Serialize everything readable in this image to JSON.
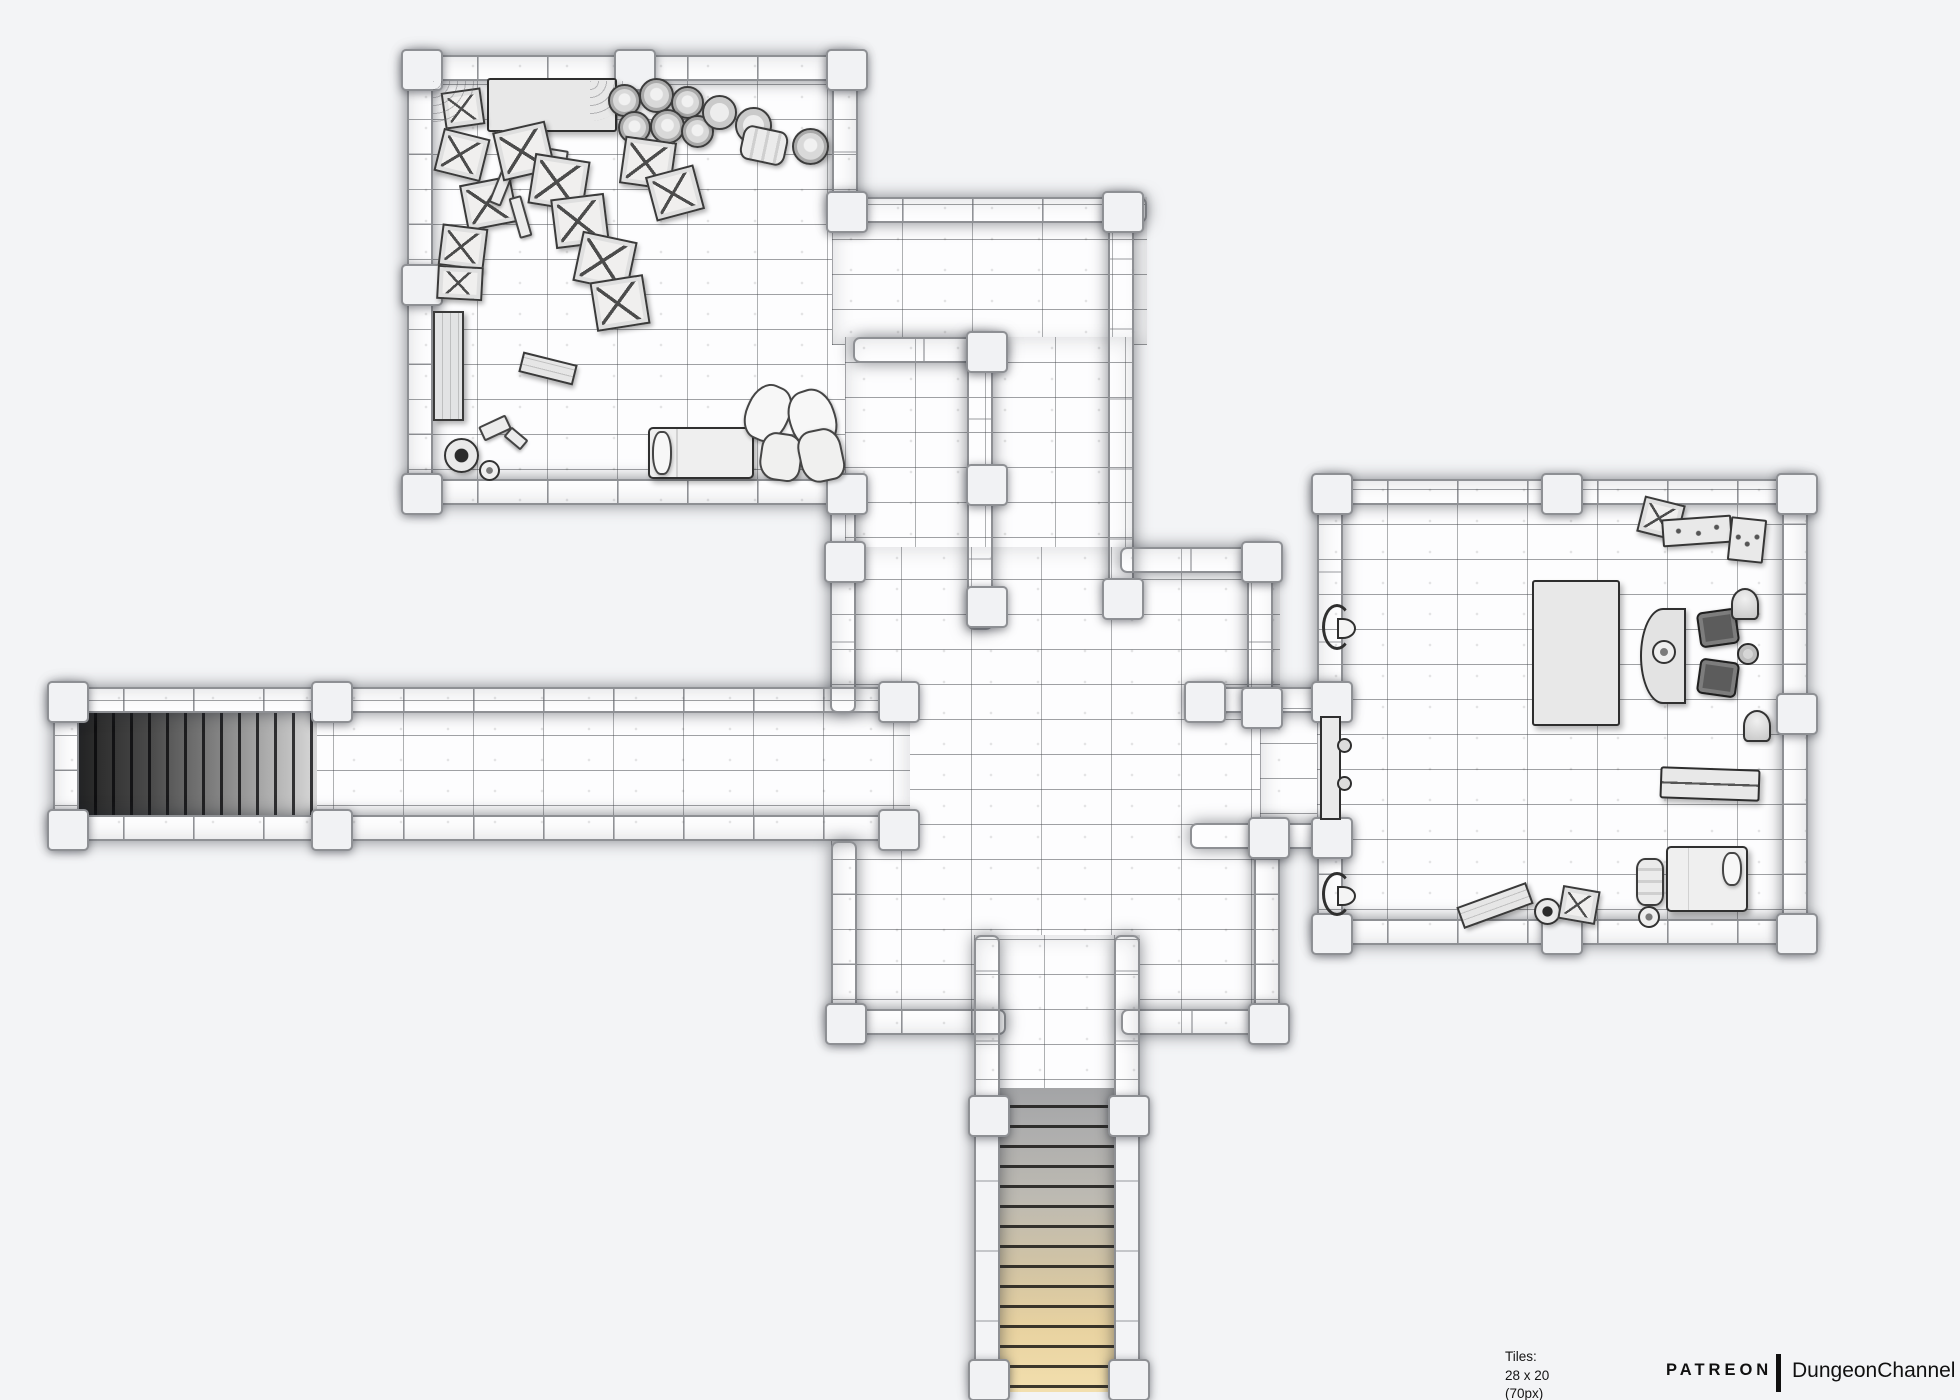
{
  "footer": {
    "tiles_label": "Tiles: 28 x 20 (70px)",
    "image_label": "Image: 1960 x 1400px",
    "brand": "PATREON",
    "channel": "DungeonChannel"
  },
  "map": {
    "colors": {
      "backdrop": "#f3f4f6",
      "floor": "#fdfdfe",
      "wall": "#e3e4e6",
      "wall_border": "#8e9094",
      "stairs_dark": "#242424",
      "stairs_light": "#d8d8d8",
      "stairs_tan": "#f2dfae"
    },
    "tile_size_px": 70,
    "grid": {
      "cols": 28,
      "rows": 20
    },
    "floors": [
      {
        "id": "storage-room",
        "x": 407,
        "y": 55,
        "w": 451,
        "h": 450
      },
      {
        "id": "east-corridor",
        "x": 832,
        "y": 197,
        "w": 315,
        "h": 148
      },
      {
        "id": "north-passages",
        "x": 845,
        "y": 337,
        "w": 289,
        "h": 236
      },
      {
        "id": "central-hall",
        "x": 831,
        "y": 547,
        "w": 449,
        "h": 488
      },
      {
        "id": "west-corridor",
        "x": 53,
        "y": 687,
        "w": 857,
        "h": 154
      },
      {
        "id": "door-passage",
        "x": 1260,
        "y": 687,
        "w": 83,
        "h": 162
      },
      {
        "id": "south-corridor",
        "x": 974,
        "y": 935,
        "w": 166,
        "h": 180
      },
      {
        "id": "study-bedroom",
        "x": 1317,
        "y": 479,
        "w": 491,
        "h": 466
      }
    ],
    "walls": [
      {
        "x": 407,
        "y": 55,
        "w": 451,
        "h": 26
      },
      {
        "x": 407,
        "y": 55,
        "w": 26,
        "h": 450
      },
      {
        "x": 407,
        "y": 479,
        "w": 451,
        "h": 26
      },
      {
        "x": 832,
        "y": 55,
        "w": 26,
        "h": 168
      },
      {
        "x": 830,
        "y": 505,
        "w": 26,
        "h": 208
      },
      {
        "x": 832,
        "y": 197,
        "w": 315,
        "h": 26
      },
      {
        "x": 853,
        "y": 337,
        "w": 153,
        "h": 26
      },
      {
        "x": 1108,
        "y": 197,
        "w": 26,
        "h": 413
      },
      {
        "x": 967,
        "y": 337,
        "w": 26,
        "h": 293
      },
      {
        "x": 1120,
        "y": 547,
        "w": 153,
        "h": 26
      },
      {
        "x": 1247,
        "y": 547,
        "w": 26,
        "h": 166
      },
      {
        "x": 1190,
        "y": 687,
        "w": 157,
        "h": 26
      },
      {
        "x": 1190,
        "y": 823,
        "w": 157,
        "h": 26
      },
      {
        "x": 1254,
        "y": 823,
        "w": 26,
        "h": 212
      },
      {
        "x": 1317,
        "y": 479,
        "w": 26,
        "h": 234
      },
      {
        "x": 1317,
        "y": 823,
        "w": 26,
        "h": 122
      },
      {
        "x": 1317,
        "y": 479,
        "w": 491,
        "h": 26
      },
      {
        "x": 1782,
        "y": 479,
        "w": 26,
        "h": 466
      },
      {
        "x": 1317,
        "y": 919,
        "w": 491,
        "h": 26
      },
      {
        "x": 53,
        "y": 687,
        "w": 857,
        "h": 26
      },
      {
        "x": 53,
        "y": 815,
        "w": 857,
        "h": 26
      },
      {
        "x": 53,
        "y": 687,
        "w": 26,
        "h": 154
      },
      {
        "x": 831,
        "y": 841,
        "w": 26,
        "h": 194
      },
      {
        "x": 831,
        "y": 1009,
        "w": 175,
        "h": 26
      },
      {
        "x": 1121,
        "y": 1009,
        "w": 159,
        "h": 26
      },
      {
        "x": 974,
        "y": 935,
        "w": 26,
        "h": 457
      },
      {
        "x": 1114,
        "y": 935,
        "w": 26,
        "h": 457
      }
    ],
    "pillars": [
      {
        "x": 420,
        "y": 68
      },
      {
        "x": 633,
        "y": 68
      },
      {
        "x": 845,
        "y": 68
      },
      {
        "x": 420,
        "y": 283
      },
      {
        "x": 420,
        "y": 492
      },
      {
        "x": 845,
        "y": 492
      },
      {
        "x": 845,
        "y": 210
      },
      {
        "x": 985,
        "y": 350
      },
      {
        "x": 1121,
        "y": 210
      },
      {
        "x": 1121,
        "y": 597
      },
      {
        "x": 985,
        "y": 483
      },
      {
        "x": 985,
        "y": 605
      },
      {
        "x": 843,
        "y": 560
      },
      {
        "x": 1260,
        "y": 560
      },
      {
        "x": 1260,
        "y": 706
      },
      {
        "x": 1203,
        "y": 700
      },
      {
        "x": 1330,
        "y": 700
      },
      {
        "x": 1330,
        "y": 836
      },
      {
        "x": 1267,
        "y": 836
      },
      {
        "x": 1267,
        "y": 1022
      },
      {
        "x": 844,
        "y": 1022
      },
      {
        "x": 897,
        "y": 828
      },
      {
        "x": 897,
        "y": 700
      },
      {
        "x": 66,
        "y": 700
      },
      {
        "x": 66,
        "y": 828
      },
      {
        "x": 330,
        "y": 700
      },
      {
        "x": 330,
        "y": 828
      },
      {
        "x": 987,
        "y": 1114
      },
      {
        "x": 1127,
        "y": 1114
      },
      {
        "x": 987,
        "y": 1378
      },
      {
        "x": 1127,
        "y": 1378
      },
      {
        "x": 1330,
        "y": 492
      },
      {
        "x": 1560,
        "y": 492
      },
      {
        "x": 1795,
        "y": 492
      },
      {
        "x": 1795,
        "y": 712
      },
      {
        "x": 1795,
        "y": 932
      },
      {
        "x": 1560,
        "y": 932
      },
      {
        "x": 1330,
        "y": 932
      }
    ],
    "stairs": [
      {
        "id": "west-stairs",
        "dir": "west",
        "x": 79,
        "y": 713,
        "w": 238,
        "h": 102,
        "steps": 13
      },
      {
        "id": "south-stairs",
        "dir": "south",
        "x": 1000,
        "y": 1088,
        "w": 114,
        "h": 304,
        "steps": 15
      }
    ],
    "furniture": [
      {
        "t": "table",
        "x": 487,
        "y": 78,
        "w": 130,
        "h": 54
      },
      {
        "t": "crate",
        "x": 443,
        "y": 90,
        "w": 40,
        "h": 37,
        "r": -8
      },
      {
        "t": "web",
        "x": 433,
        "y": 81,
        "w": 46,
        "h": 46
      },
      {
        "t": "web",
        "x": 590,
        "y": 81,
        "w": 40,
        "h": 40
      },
      {
        "t": "barrel",
        "x": 608,
        "y": 84,
        "w": 33
      },
      {
        "t": "barrel",
        "x": 639,
        "y": 78,
        "w": 35
      },
      {
        "t": "barrel",
        "x": 671,
        "y": 86,
        "w": 33
      },
      {
        "t": "barrel",
        "x": 618,
        "y": 111,
        "w": 33
      },
      {
        "t": "barrel",
        "x": 650,
        "y": 109,
        "w": 35
      },
      {
        "t": "barrel",
        "x": 681,
        "y": 115,
        "w": 33
      },
      {
        "t": "ring",
        "x": 702,
        "y": 95,
        "w": 35
      },
      {
        "t": "ring",
        "x": 735,
        "y": 107,
        "w": 37
      },
      {
        "t": "keg",
        "x": 741,
        "y": 128,
        "w": 46,
        "h": 35,
        "r": 12
      },
      {
        "t": "barrel",
        "x": 792,
        "y": 128,
        "w": 37
      },
      {
        "t": "crate",
        "x": 438,
        "y": 133,
        "w": 48,
        "h": 44,
        "r": 14
      },
      {
        "t": "crate",
        "x": 463,
        "y": 180,
        "w": 52,
        "h": 47,
        "r": -11
      },
      {
        "t": "crate",
        "x": 440,
        "y": 226,
        "w": 46,
        "h": 42,
        "r": 7
      },
      {
        "t": "plank",
        "x": 497,
        "y": 158,
        "w": 13,
        "h": 48,
        "r": 22
      },
      {
        "t": "plank",
        "x": 514,
        "y": 196,
        "w": 13,
        "h": 42,
        "r": -16
      },
      {
        "t": "plank",
        "x": 532,
        "y": 148,
        "w": 36,
        "h": 14,
        "r": 9
      },
      {
        "t": "crate",
        "x": 497,
        "y": 126,
        "w": 54,
        "h": 50,
        "r": -13
      },
      {
        "t": "crate",
        "x": 531,
        "y": 157,
        "w": 56,
        "h": 51,
        "r": 9
      },
      {
        "t": "crate",
        "x": 553,
        "y": 196,
        "w": 54,
        "h": 50,
        "r": -7
      },
      {
        "t": "crate",
        "x": 577,
        "y": 236,
        "w": 56,
        "h": 51,
        "r": 12
      },
      {
        "t": "crate",
        "x": 593,
        "y": 278,
        "w": 54,
        "h": 50,
        "r": -9
      },
      {
        "t": "crate",
        "x": 622,
        "y": 139,
        "w": 52,
        "h": 48,
        "r": 8
      },
      {
        "t": "crate",
        "x": 650,
        "y": 170,
        "w": 50,
        "h": 46,
        "r": -15
      },
      {
        "t": "crate",
        "x": 437,
        "y": 266,
        "w": 46,
        "h": 34,
        "r": 3
      },
      {
        "t": "bench-v",
        "x": 433,
        "y": 311,
        "w": 31,
        "h": 110
      },
      {
        "t": "plank",
        "x": 480,
        "y": 420,
        "w": 30,
        "h": 16,
        "r": -25
      },
      {
        "t": "plank",
        "x": 505,
        "y": 432,
        "w": 22,
        "h": 13,
        "r": 40
      },
      {
        "t": "pot",
        "x": 444,
        "y": 438,
        "w": 35
      },
      {
        "t": "pot-small",
        "x": 479,
        "y": 460,
        "w": 21
      },
      {
        "t": "bench",
        "x": 520,
        "y": 358,
        "w": 56,
        "h": 21,
        "r": 14
      },
      {
        "t": "bed",
        "x": 648,
        "y": 427,
        "w": 106,
        "h": 52
      },
      {
        "t": "pillow",
        "x": 652,
        "y": 431,
        "w": 20,
        "h": 44
      },
      {
        "t": "pillow",
        "x": 746,
        "y": 384,
        "w": 44,
        "h": 58,
        "r": 24
      },
      {
        "t": "pillow",
        "x": 789,
        "y": 389,
        "w": 47,
        "h": 60,
        "r": -18
      },
      {
        "t": "sack",
        "x": 760,
        "y": 433,
        "w": 42,
        "h": 48,
        "r": 8
      },
      {
        "t": "sack",
        "x": 799,
        "y": 429,
        "w": 44,
        "h": 53,
        "r": -12
      },
      {
        "t": "torch",
        "x": 1322,
        "y": 604,
        "w": 30,
        "h": 46
      },
      {
        "t": "torch",
        "x": 1322,
        "y": 872,
        "w": 30,
        "h": 44
      },
      {
        "t": "door",
        "x": 1320,
        "y": 716,
        "w": 21,
        "h": 104
      },
      {
        "t": "crate",
        "x": 1640,
        "y": 500,
        "w": 42,
        "h": 37,
        "r": 14
      },
      {
        "t": "desk",
        "x": 1662,
        "y": 517,
        "w": 70,
        "h": 28,
        "r": -4
      },
      {
        "t": "desk",
        "x": 1729,
        "y": 518,
        "w": 36,
        "h": 44,
        "r": 6
      },
      {
        "t": "table",
        "x": 1532,
        "y": 580,
        "w": 88,
        "h": 146
      },
      {
        "t": "half-table",
        "x": 1640,
        "y": 608,
        "w": 46,
        "h": 96
      },
      {
        "t": "pot-small",
        "x": 1652,
        "y": 640,
        "w": 24
      },
      {
        "t": "chair",
        "x": 1698,
        "y": 610,
        "w": 40,
        "h": 36,
        "r": -8
      },
      {
        "t": "chair",
        "x": 1698,
        "y": 660,
        "w": 40,
        "h": 36,
        "r": 8
      },
      {
        "t": "stool",
        "x": 1737,
        "y": 643,
        "w": 22
      },
      {
        "t": "bell",
        "x": 1731,
        "y": 588,
        "w": 28,
        "h": 32
      },
      {
        "t": "bell",
        "x": 1743,
        "y": 710,
        "w": 28,
        "h": 32
      },
      {
        "t": "chest",
        "x": 1660,
        "y": 768,
        "w": 100,
        "h": 32,
        "r": 2
      },
      {
        "t": "keg-v",
        "x": 1636,
        "y": 858,
        "w": 28,
        "h": 48
      },
      {
        "t": "pot-small",
        "x": 1638,
        "y": 906,
        "w": 22
      },
      {
        "t": "bed",
        "x": 1666,
        "y": 846,
        "w": 82,
        "h": 66
      },
      {
        "t": "pillow",
        "x": 1722,
        "y": 852,
        "w": 20,
        "h": 34
      },
      {
        "t": "bench",
        "x": 1458,
        "y": 894,
        "w": 74,
        "h": 23,
        "r": -20
      },
      {
        "t": "pot",
        "x": 1534,
        "y": 898,
        "w": 27
      },
      {
        "t": "crate",
        "x": 1560,
        "y": 888,
        "w": 38,
        "h": 34,
        "r": 10
      }
    ]
  }
}
